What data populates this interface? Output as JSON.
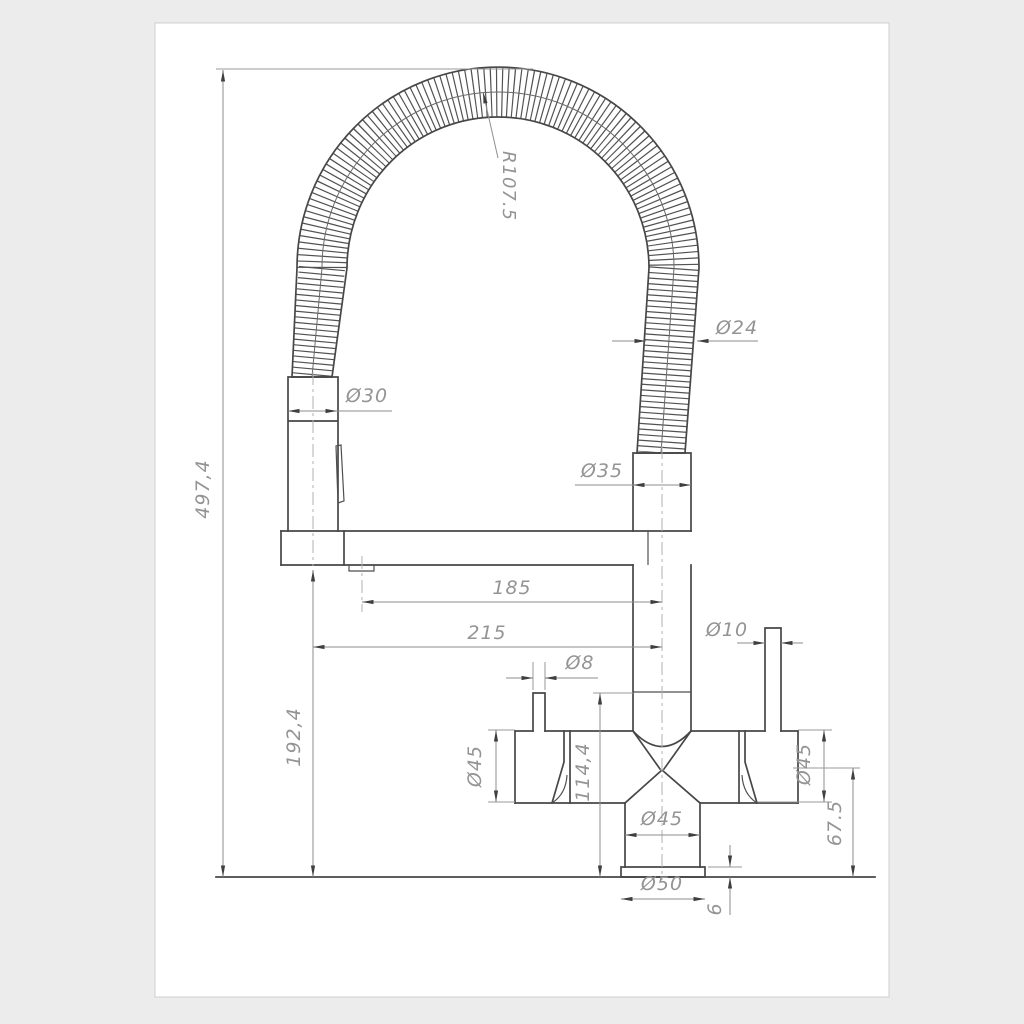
{
  "drawing": {
    "type": "technical-drawing",
    "subject": "kitchen faucet with flexible spring spout - dimensional drawing",
    "colors": {
      "paper": "#ffffff",
      "background": "#ececec",
      "outline": "#474747",
      "dimension_lines": "#8e8e8e",
      "dimension_text": "#949494"
    },
    "dims": {
      "overall_height": "497,4",
      "spout_underside_height": "192,4",
      "hose_bend_radius": "R107.5",
      "hose_diameter": "Ø24",
      "sprayer_collar_diameter": "Ø30",
      "hose_connector_diameter": "Ø35",
      "spout_reach": "185",
      "total_reach": "215",
      "right_handle_diameter": "Ø10",
      "left_handle_diameter": "Ø8",
      "body_top_height": "114,4",
      "left_valve_body_diameter": "Ø45",
      "right_valve_body_diameter": "Ø45",
      "right_body_bottom_height": "67.5",
      "base_column_diameter": "Ø45",
      "base_flange_diameter": "Ø50",
      "base_flange_height": "6"
    }
  }
}
